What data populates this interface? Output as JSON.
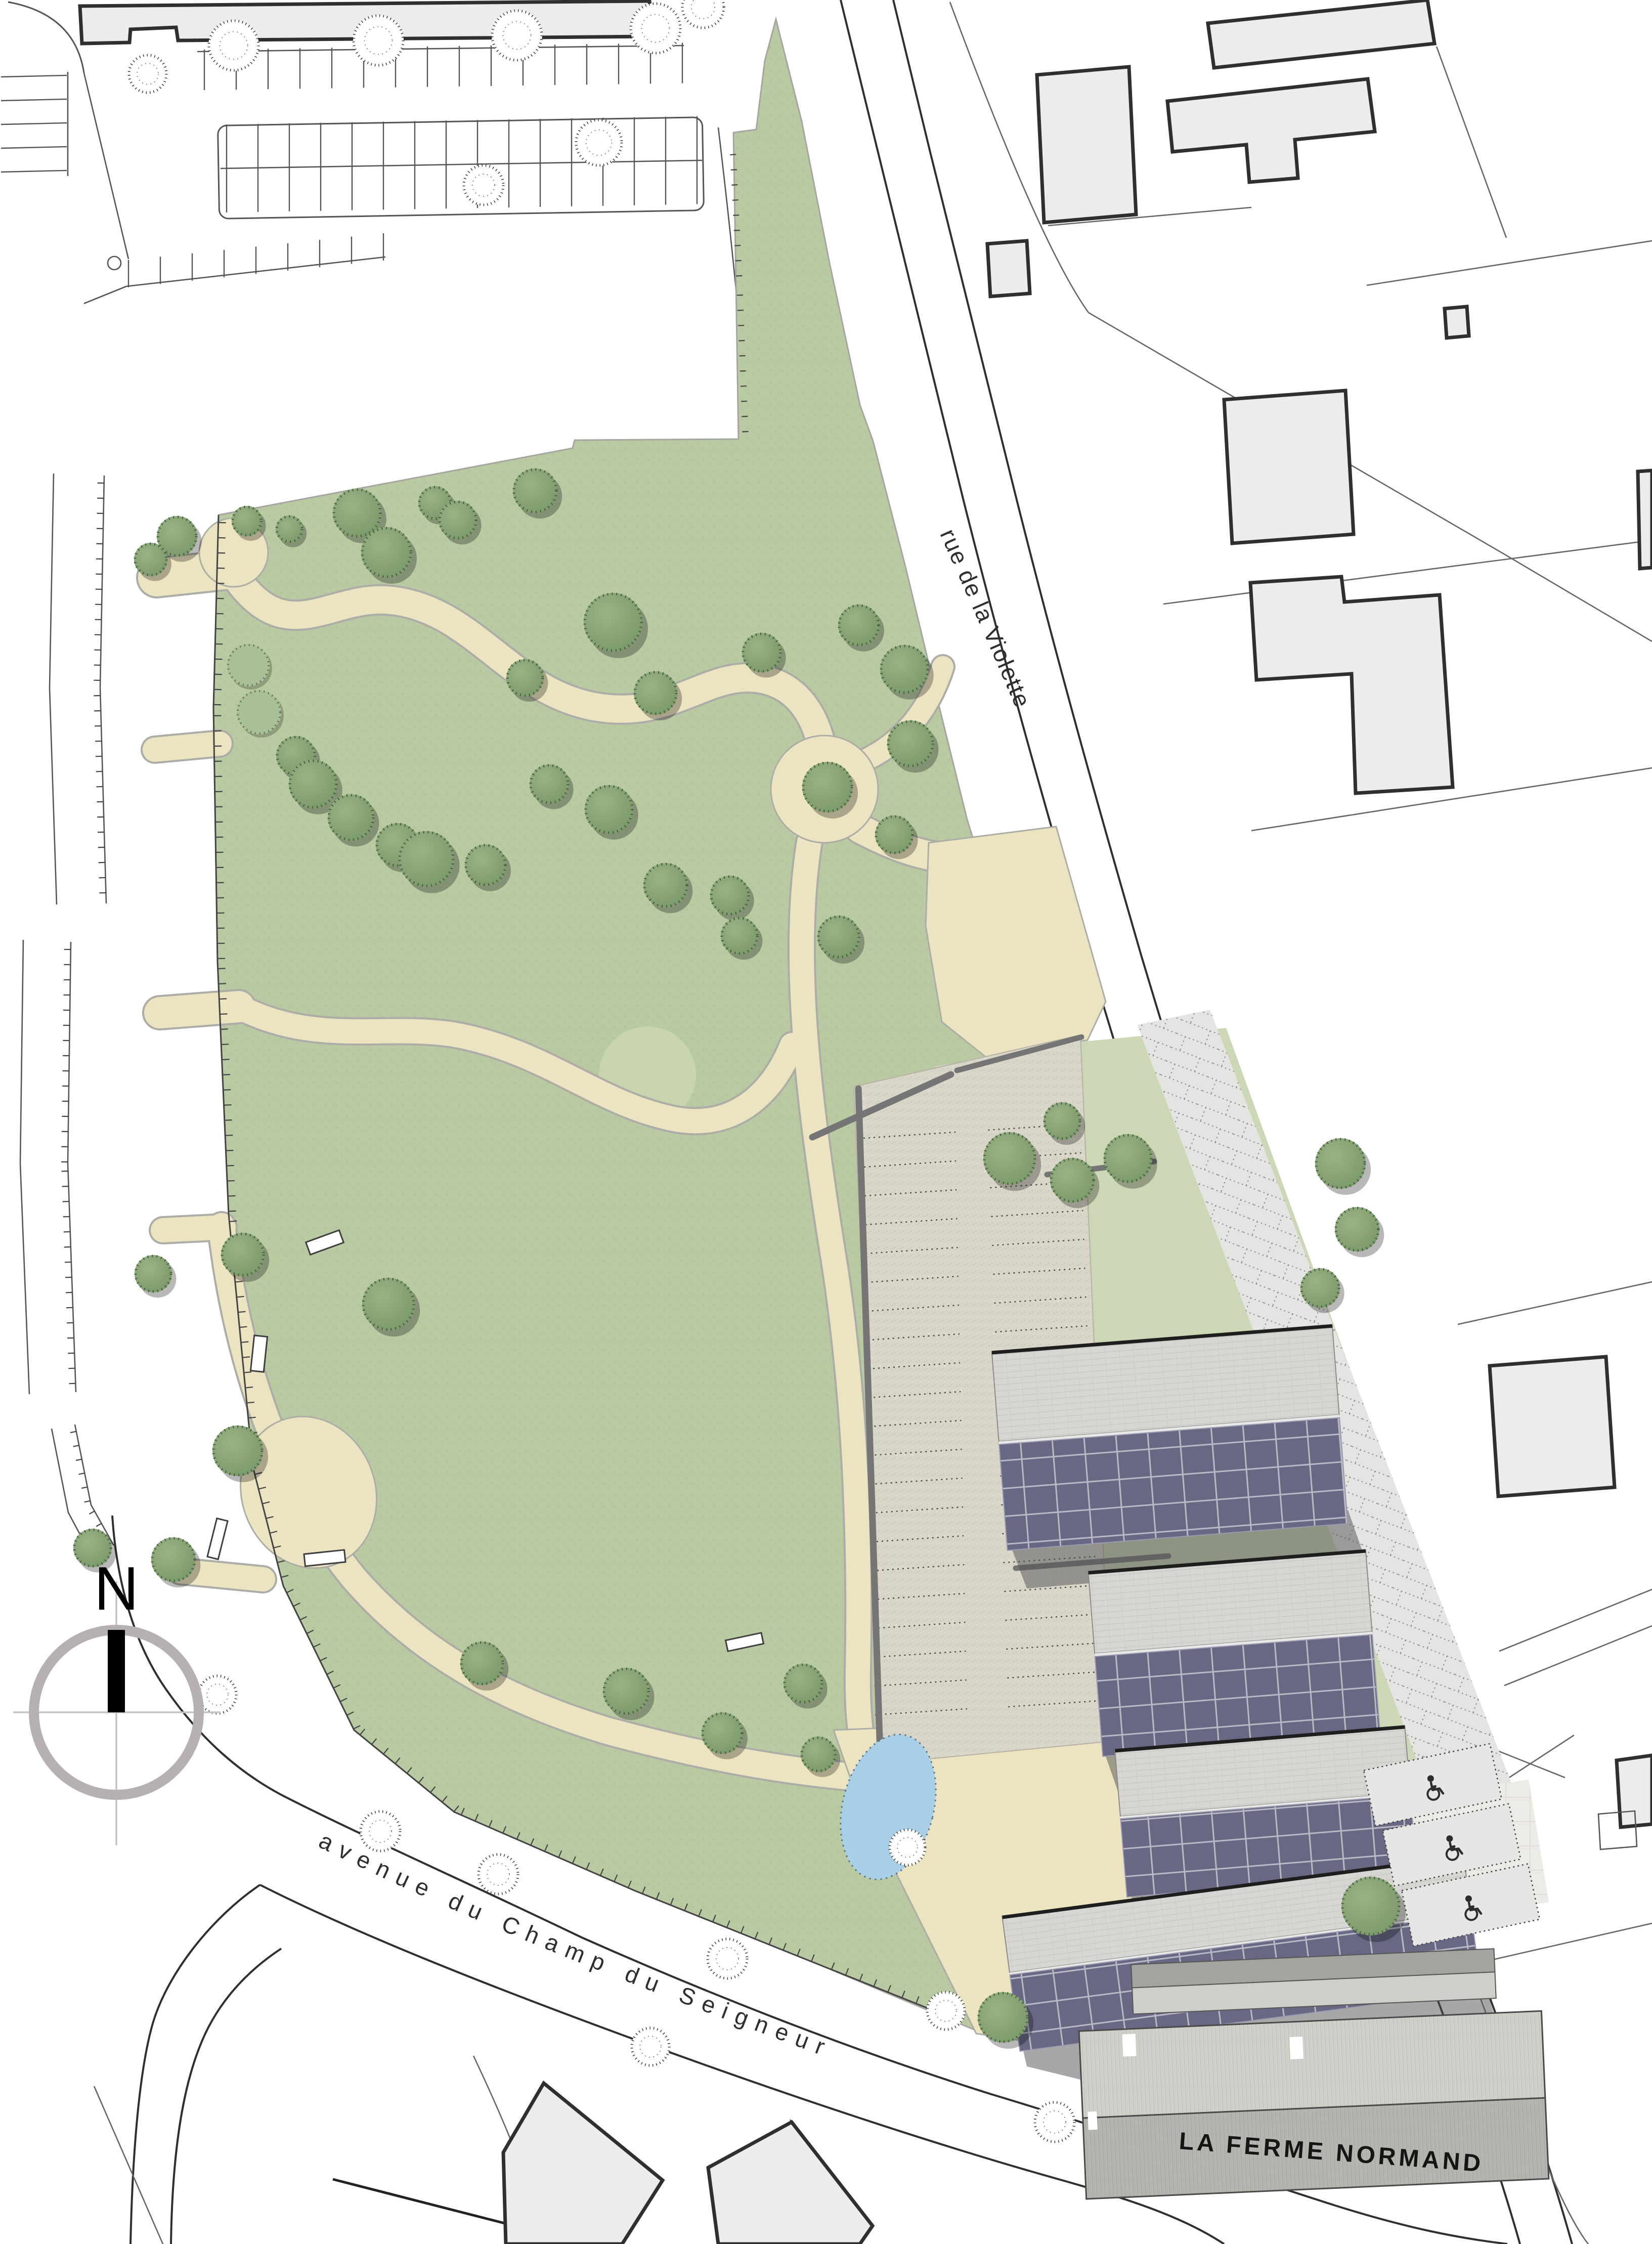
{
  "document": {
    "type": "landscape site plan",
    "site_features": [
      "public park with winding paths",
      "row houses with solar roofs",
      "gravel parking court",
      "pond",
      "farm building"
    ]
  },
  "labels": {
    "street_violette": "rue de la Violette",
    "street_seigneur": "avenue du Champ du Seigneur",
    "farm_name": "LA FERME NORMAND",
    "compass_north": "N"
  },
  "palette": {
    "lawn": "#b9c9a1",
    "lawn_light": "#c7d4ae",
    "tree_green": "#85a274",
    "tree_green_dark": "#4a6342",
    "bush_pale": "#a9bf98",
    "path_beige": "#ece4c1",
    "path_edge": "#adada8",
    "gravel": "#d9d5c9",
    "garden_pale": "#ccd8b5",
    "paving_light": "#e4e4e2",
    "forecourt": "#edebe5",
    "solar_panel": "#686884",
    "solar_grid": "#b9b9c6",
    "roof_gray": "#d7d6d2",
    "barn_roof": "#d0d0ca",
    "water": "#a9cfe7",
    "building_context": "#ececec",
    "outline_dark": "#2f2f2f",
    "parcel_line": "#666666",
    "wall_gray": "#757575",
    "shadow": "rgba(80,80,80,0.5)",
    "compass_ring": "#b7b0b0",
    "label_text": "#2e2e2e"
  }
}
